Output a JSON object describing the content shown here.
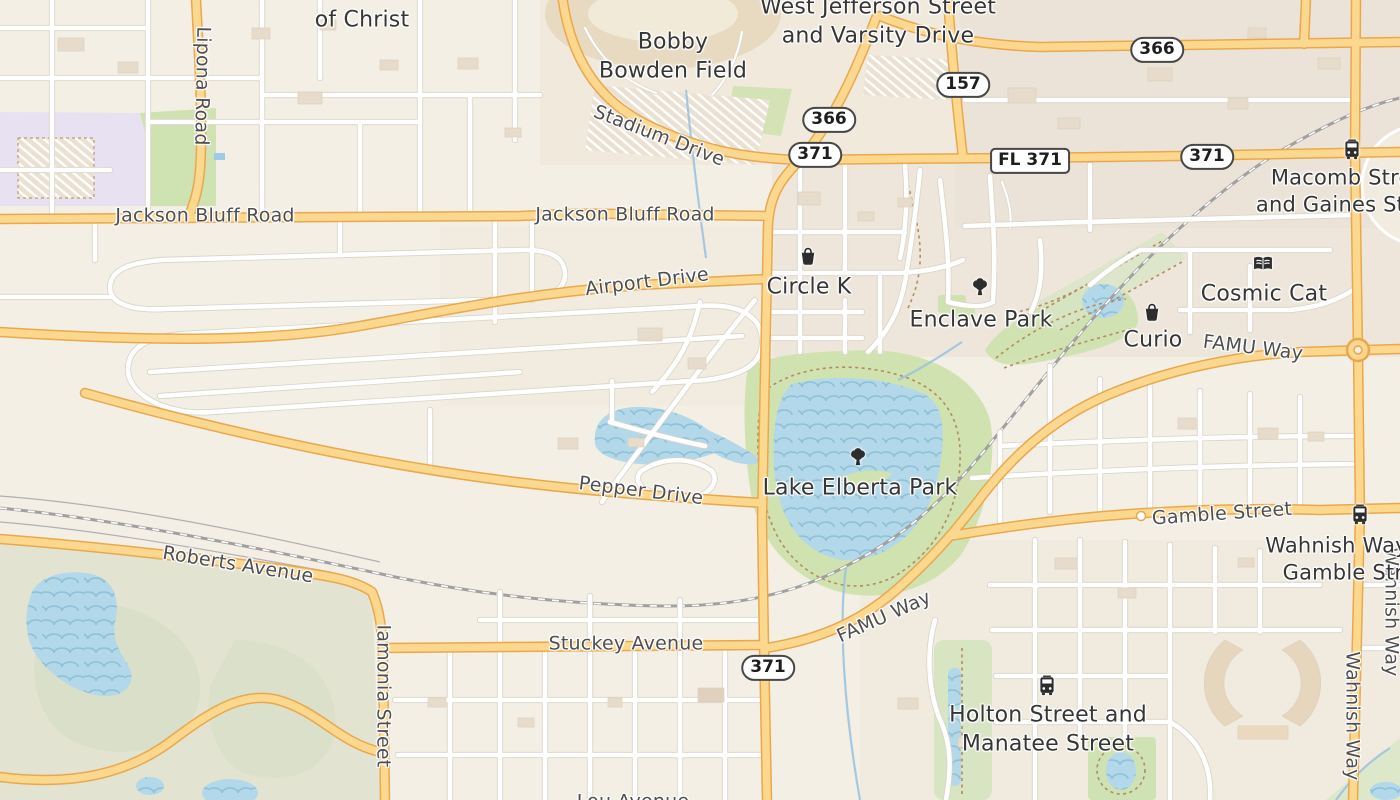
{
  "map": {
    "app": "map-view",
    "colors": {
      "base": "#f3efe4",
      "block": "#ece3d8",
      "campus": "#e8e1f1",
      "park": "#cfe2b0",
      "field": "#e2e4d1",
      "water": "#b3d8ea",
      "wave": "#8fc1d6",
      "road_fill": "#fcd88f",
      "road_casing": "#e9a84e",
      "street_casing": "#d8d3c8",
      "rail": "#a0a0a0",
      "stream": "#9cc3e0",
      "building": "#e7dccc",
      "path_dash": "#b48a5e",
      "label_road": "#4f4f4f",
      "label_poi": "#363636",
      "icon": "#2d2d2d",
      "shield_border": "#474747"
    },
    "labels": [
      {
        "id": "lipona-road",
        "text": "Lipona Road",
        "x": 202,
        "y": 86,
        "rot": 91,
        "size": 19,
        "kind": "road"
      },
      {
        "id": "jackson-bluff-road-w",
        "text": "Jackson Bluff Road",
        "x": 205,
        "y": 216,
        "rot": 0,
        "size": 19,
        "kind": "road"
      },
      {
        "id": "jackson-bluff-road-c",
        "text": "Jackson Bluff Road",
        "x": 625,
        "y": 215,
        "rot": 0,
        "size": 19,
        "kind": "road"
      },
      {
        "id": "stadium-drive",
        "text": "Stadium Drive",
        "x": 659,
        "y": 136,
        "rot": 21,
        "size": 19,
        "kind": "road"
      },
      {
        "id": "airport-drive",
        "text": "Airport Drive",
        "x": 647,
        "y": 282,
        "rot": -7,
        "size": 19,
        "kind": "road"
      },
      {
        "id": "pepper-drive",
        "text": "Pepper Drive",
        "x": 641,
        "y": 491,
        "rot": 7,
        "size": 19,
        "kind": "road"
      },
      {
        "id": "roberts-avenue",
        "text": "Roberts Avenue",
        "x": 238,
        "y": 565,
        "rot": 9,
        "size": 19,
        "kind": "road"
      },
      {
        "id": "iamonia-street",
        "text": "Iamonia Street",
        "x": 383,
        "y": 696,
        "rot": 90,
        "size": 19,
        "kind": "road"
      },
      {
        "id": "stuckey-avenue",
        "text": "Stuckey Avenue",
        "x": 626,
        "y": 644,
        "rot": 0,
        "size": 19,
        "kind": "road"
      },
      {
        "id": "famu-way-sw",
        "text": "FAMU Way",
        "x": 884,
        "y": 617,
        "rot": -24,
        "size": 19,
        "kind": "road"
      },
      {
        "id": "famu-way-ne",
        "text": "FAMU Way",
        "x": 1253,
        "y": 348,
        "rot": 7,
        "size": 19,
        "kind": "road"
      },
      {
        "id": "gamble-street",
        "text": "Gamble Street",
        "x": 1222,
        "y": 514,
        "rot": -4,
        "size": 19,
        "kind": "road"
      },
      {
        "id": "wahnish-way-s",
        "text": "Wahnish Way",
        "x": 1352,
        "y": 716,
        "rot": 90,
        "size": 19,
        "kind": "road"
      },
      {
        "id": "wahnish-way-e",
        "text": "Wahnish Way",
        "x": 1391,
        "y": 612,
        "rot": 90,
        "size": 19,
        "kind": "road"
      },
      {
        "id": "lou-avenue",
        "text": "Lou Avenue",
        "x": 633,
        "y": 802,
        "rot": 0,
        "size": 19,
        "kind": "road"
      },
      {
        "id": "of-christ",
        "text": "of Christ",
        "x": 362,
        "y": 21,
        "rot": 0,
        "size": 22,
        "kind": "poi"
      },
      {
        "id": "bobby-bowden-field",
        "text": "Bobby\nBowden Field",
        "x": 673,
        "y": 57,
        "rot": 0,
        "size": 22,
        "kind": "poi"
      },
      {
        "id": "west-jefferson-varsity",
        "text": "West Jefferson Street\nand Varsity Drive",
        "x": 878,
        "y": 22,
        "rot": 0,
        "size": 22,
        "kind": "junction"
      },
      {
        "id": "circle-k",
        "text": "Circle K",
        "x": 809,
        "y": 288,
        "rot": 0,
        "size": 22,
        "kind": "poi"
      },
      {
        "id": "enclave-park",
        "text": "Enclave Park",
        "x": 981,
        "y": 321,
        "rot": 0,
        "size": 22,
        "kind": "poi"
      },
      {
        "id": "cosmic-cat",
        "text": "Cosmic Cat",
        "x": 1264,
        "y": 295,
        "rot": 0,
        "size": 22,
        "kind": "poi"
      },
      {
        "id": "curio",
        "text": "Curio",
        "x": 1153,
        "y": 341,
        "rot": 0,
        "size": 22,
        "kind": "poi"
      },
      {
        "id": "lake-elberta-park",
        "text": "Lake Elberta Park",
        "x": 860,
        "y": 489,
        "rot": 0,
        "size": 22,
        "kind": "poi"
      },
      {
        "id": "macomb-gaines",
        "text": "Macomb Street\nand Gaines Street",
        "x": 1352,
        "y": 192,
        "rot": 0,
        "size": 21,
        "kind": "junction"
      },
      {
        "id": "wahnish-gamble",
        "text": "Wahnish Way and\nGamble Street",
        "x": 1360,
        "y": 560,
        "rot": 0,
        "size": 21,
        "kind": "junction"
      },
      {
        "id": "holton-manatee",
        "text": "Holton Street and\nManatee Street",
        "x": 1048,
        "y": 730,
        "rot": 0,
        "size": 22,
        "kind": "junction"
      }
    ],
    "shields": [
      {
        "text": "366",
        "x": 1157,
        "y": 50,
        "variant": "pill"
      },
      {
        "text": "157",
        "x": 963,
        "y": 85,
        "variant": "pill"
      },
      {
        "text": "366",
        "x": 829,
        "y": 120,
        "variant": "pill"
      },
      {
        "text": "371",
        "x": 815,
        "y": 155,
        "variant": "pill"
      },
      {
        "text": "FL 371",
        "x": 1030,
        "y": 161,
        "variant": "rect"
      },
      {
        "text": "371",
        "x": 1207,
        "y": 157,
        "variant": "pill"
      },
      {
        "text": "371",
        "x": 768,
        "y": 668,
        "variant": "pill"
      }
    ],
    "icons": [
      {
        "name": "bag-icon",
        "x": 808,
        "y": 256
      },
      {
        "name": "tree-icon",
        "x": 980,
        "y": 288
      },
      {
        "name": "book-icon",
        "x": 1263,
        "y": 264
      },
      {
        "name": "bag-icon",
        "x": 1152,
        "y": 312
      },
      {
        "name": "tree-icon",
        "x": 858,
        "y": 458
      },
      {
        "name": "bus-icon",
        "x": 1352,
        "y": 150
      },
      {
        "name": "bus-icon",
        "x": 1360,
        "y": 515
      },
      {
        "name": "bus-icon",
        "x": 1047,
        "y": 686
      }
    ]
  }
}
